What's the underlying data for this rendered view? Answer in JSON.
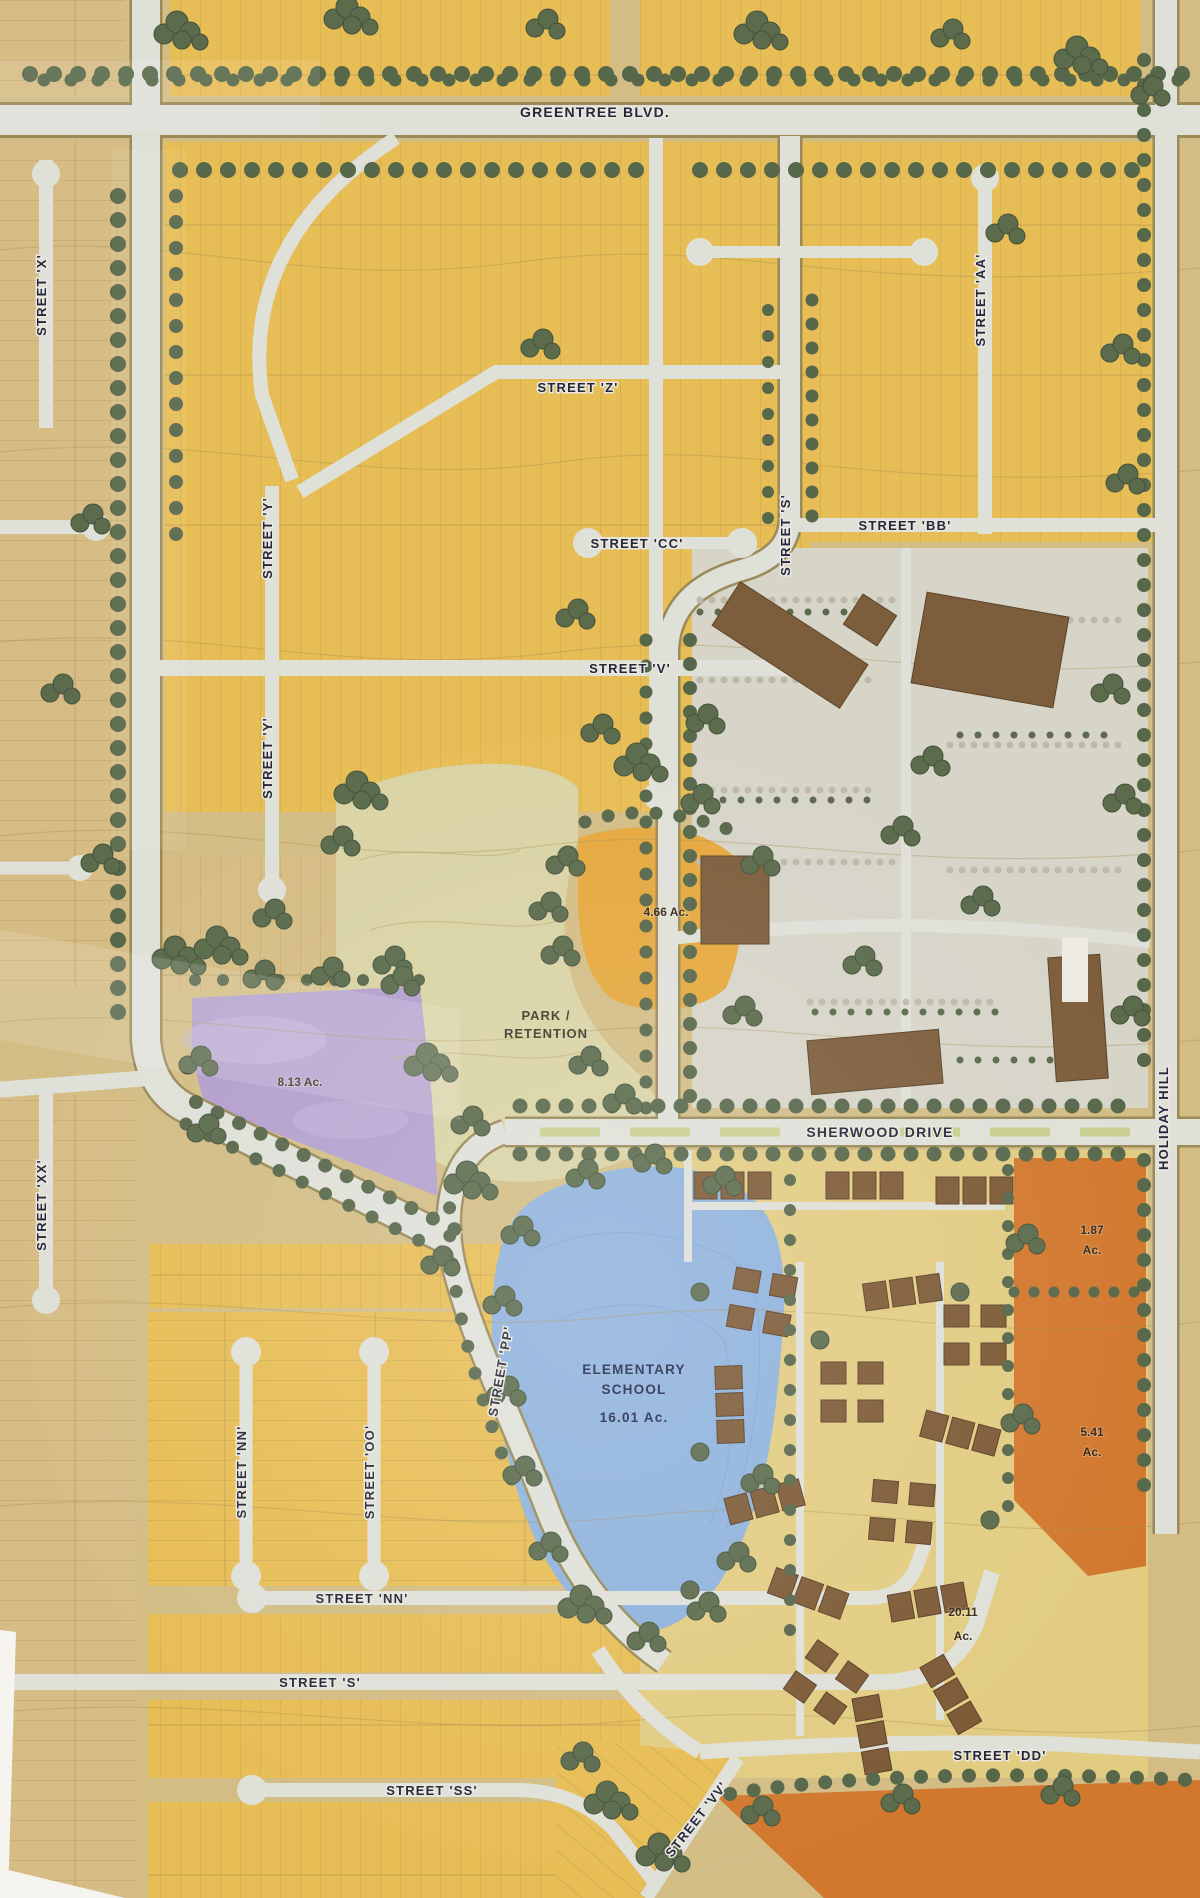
{
  "map": {
    "streets": {
      "greentree": "GREENTREE BLVD.",
      "x": "STREET 'X'",
      "z": "STREET 'Z'",
      "aa": "STREET 'AA'",
      "cc": "STREET 'CC'",
      "s": "STREET 'S'",
      "bb": "STREET 'BB'",
      "v": "STREET 'V'",
      "y": "STREET 'Y'",
      "sherwood": "SHERWOOD DRIVE",
      "holiday_hill": "HOLIDAY HILL",
      "xx": "STREET 'XX'",
      "pp": "STREET 'PP'",
      "nn": "STREET 'NN'",
      "oo": "STREET 'OO'",
      "ss": "STREET 'SS'",
      "vv": "STREET 'VV'",
      "dd": "STREET 'DD'"
    },
    "parcels": {
      "park_line1": "PARK /",
      "park_line2": "RETENTION",
      "orange_ac": "4.66 Ac.",
      "purple_ac": "8.13 Ac.",
      "school_line1": "ELEMENTARY",
      "school_line2": "SCHOOL",
      "school_ac": "16.01 Ac.",
      "mf_small_ac_line1": "1.87",
      "mf_small_ac_line2": "Ac.",
      "mf_east_ac_line1": "5.41",
      "mf_east_ac_line2": "Ac.",
      "mf_large_ac_line1": "20.11",
      "mf_large_ac_line2": "Ac."
    },
    "colors": {
      "residential_yellow": "#e7bd55",
      "tan_parcel": "#d6bd85",
      "park_green": "#d9d3a5",
      "orange_parcel": "#e5a83e",
      "purple_parcel": "#b3a0cd",
      "school_blue": "#8fb2dc",
      "multifamily_orange": "#d2782e",
      "commercial_gray": "#d7d4c8",
      "road": "#dfe0d8",
      "road_edge": "#9a8a58",
      "tree_green": "#5b6b4c",
      "building_brown": "#7d5e3c",
      "label_ink": "#26263a"
    }
  }
}
